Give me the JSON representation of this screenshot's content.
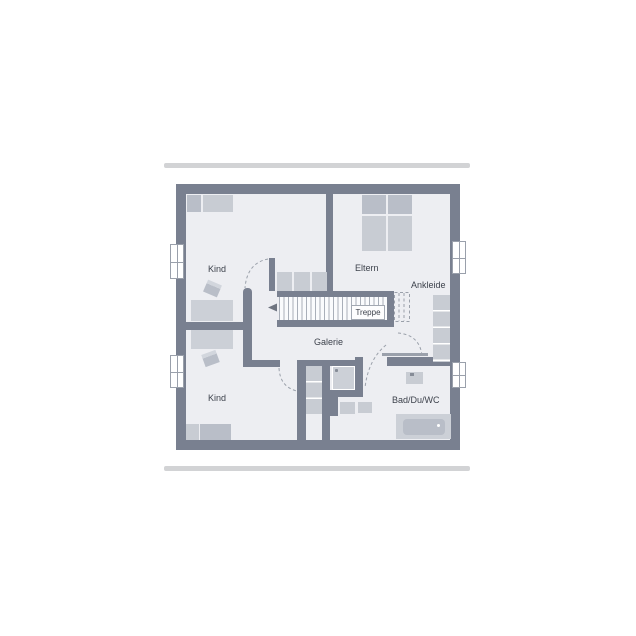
{
  "floorplan": {
    "title": "upper floor plan",
    "rooms": {
      "kind_top": {
        "label": "Kind"
      },
      "eltern": {
        "label": "Eltern"
      },
      "ankleide": {
        "label": "Ankleide"
      },
      "treppe": {
        "label": "Treppe"
      },
      "galerie": {
        "label": "Galerie"
      },
      "kind_bottom": {
        "label": "Kind"
      },
      "bad": {
        "label": "Bad/Du/WC"
      }
    },
    "colors": {
      "wall": "#798090",
      "room_fill": "#edeef2",
      "furniture_light": "#c8ccd3",
      "furniture_medium": "#b9bec8",
      "furniture_pale": "#ccd0d7",
      "line": "#9aa0ab",
      "text": "#3d424c",
      "bar": "#d2d3d5"
    }
  }
}
